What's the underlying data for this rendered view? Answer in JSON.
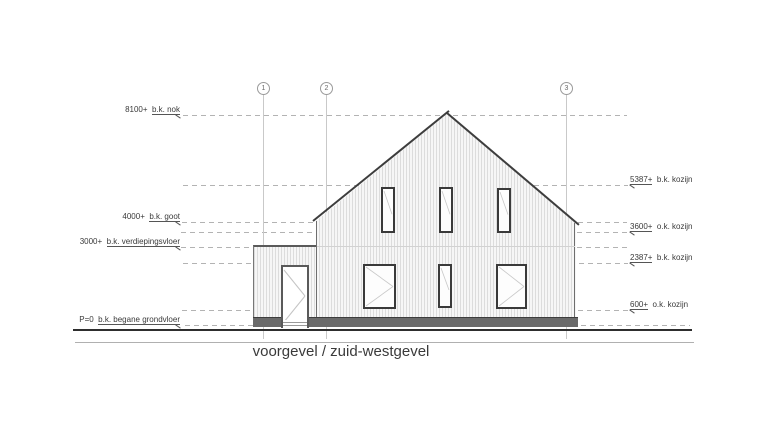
{
  "title": "voorgevel / zuid-westgevel",
  "grid_bubbles": [
    {
      "label": "1",
      "x": 263
    },
    {
      "label": "2",
      "x": 326
    },
    {
      "label": "3",
      "x": 566
    }
  ],
  "left_labels": [
    {
      "value": "8100+",
      "desc": "b.k. nok",
      "y": 115
    },
    {
      "value": "4000+",
      "desc": "b.k. goot",
      "y": 222
    },
    {
      "value": "3000+",
      "desc": "b.k. verdiepingsvloer",
      "y": 247
    },
    {
      "value": "P=0",
      "desc": "b.k. begane grondvloer",
      "y": 325
    }
  ],
  "right_labels": [
    {
      "value": "5387+",
      "desc": "b.k. kozijn",
      "y": 185
    },
    {
      "value": "3600+",
      "desc": "o.k. kozijn",
      "y": 232
    },
    {
      "value": "2387+",
      "desc": "b.k. kozijn",
      "y": 263
    },
    {
      "value": "600+",
      "desc": "o.k. kozijn",
      "y": 310
    }
  ],
  "dashed_lines": [
    {
      "level": "nok",
      "y": 115,
      "x1": 183,
      "x2": 627
    },
    {
      "level": "5387",
      "y": 185,
      "x1": 183,
      "x2": 628
    },
    {
      "level": "goot",
      "y": 222,
      "x1": 182,
      "x2": 627
    },
    {
      "level": "3600",
      "y": 232,
      "x1": 181,
      "x2": 628
    },
    {
      "level": "3000",
      "y": 247,
      "x1": 181,
      "x2": 627
    },
    {
      "level": "2387",
      "y": 263,
      "x1": 183,
      "x2": 628
    },
    {
      "level": "600",
      "y": 310,
      "x1": 182,
      "x2": 628
    },
    {
      "level": "P=0",
      "y": 325,
      "x1": 185,
      "x2": 690
    }
  ],
  "windows": [
    {
      "id": "upper-left",
      "x": 381,
      "y": 187,
      "w": 14,
      "h": 46,
      "style": "single"
    },
    {
      "id": "upper-middle",
      "x": 439,
      "y": 187,
      "w": 14,
      "h": 46,
      "style": "single"
    },
    {
      "id": "upper-right",
      "x": 497,
      "y": 188,
      "w": 14,
      "h": 45,
      "style": "single"
    },
    {
      "id": "lower-left",
      "x": 363,
      "y": 264,
      "w": 33,
      "h": 45,
      "style": "swing"
    },
    {
      "id": "lower-middle",
      "x": 438,
      "y": 264,
      "w": 14,
      "h": 44,
      "style": "single"
    },
    {
      "id": "lower-right",
      "x": 496,
      "y": 264,
      "w": 31,
      "h": 45,
      "style": "swing"
    }
  ],
  "colors": {
    "outline": "#3d3d3d",
    "plinth": "#6a6a6a",
    "dash": "#b3b3b3",
    "grid": "#c9c9c9",
    "text": "#3a3a3a",
    "siding_line": "#dcdcdc"
  }
}
